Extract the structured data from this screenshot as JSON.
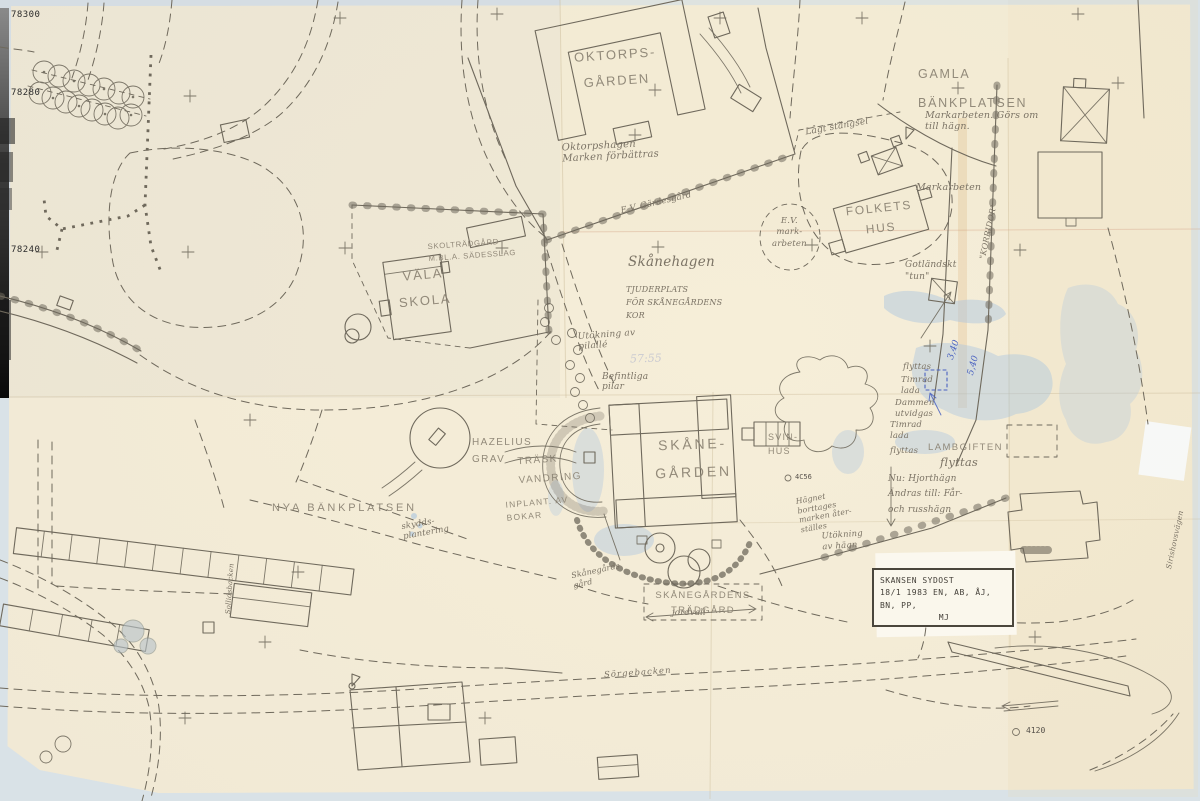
{
  "grid_labels": {
    "top": "78300",
    "middle": "78280",
    "bottom": "78240"
  },
  "survey_points": {
    "pt_4120": "4120",
    "pt_4c56": "4C56",
    "parcel": "57:55"
  },
  "measurements_blue": {
    "a": "3,40",
    "b": "5,40"
  },
  "stamp": {
    "line1": "SKANSEN SYDOST",
    "line2": "18/1 1983 EN, AB, ÅJ, BN, PP,",
    "line3": "MJ"
  },
  "labels": {
    "oktorpsgarden": "OKTORPS-\nGÅRDEN",
    "oktorpshagen": "Oktorpshagen\nMarken förbättras",
    "gamla_bankplatsen": "GAMLA\nBÄNKPLATSEN",
    "gamla_note": "Markarbeten. Görs om\ntill hägn.",
    "lagt_stangsel": "Lågt stängsel",
    "markarbeten": "Markarbeten",
    "ev_markarbeten": "E.V.\nmark-\narbeten",
    "ev_gardesgard": "E.V. Gärdesgård",
    "folkets_hus": "FOLKETS\nHUS",
    "korridor": "\"KORRIDOR\"",
    "gotlandskt_tun": "Gotländskt\n\"tun\"",
    "skanehagen": "Skånehagen",
    "tjuderplats": "TJUDERPLATS\nFÖR SKÅNEGÅRDENS\nKOR",
    "vala_skola": "VÄLA\nSKOLA",
    "skoltradgard": "SKOLTRÄDGÅRD\nM.BL.A. SÄDESSLAG",
    "utokning_pilalle": "Utökning av\npilallé",
    "befintliga_pilar": "Befintliga\npilar",
    "skanegarden": "SKÅNE-\nGÅRDEN",
    "svinhus": "SVIN-\nHUS",
    "hazelius_grav": "HAZELIUS\nGRAV",
    "traskvandring": "TRÄSK-\nVANDRING",
    "inplant_bokar": "INPLANT. AV\nBOKAR",
    "nya_bankplatsen": "NYA BÄNKPLATSEN",
    "skyddsplantering": "skydds-\nplantering",
    "flyttas_a": "flyttas",
    "timrad_lada_a": "Timrad\nlada",
    "dammen_utvidgas": "Dammen\nutvidgas",
    "timrad_lada_b": "Timrad\nlada",
    "flyttas_b": "flyttas",
    "lambgiften": "LAMBGIFTEN",
    "lambgiften_note": "flyttas",
    "hjorthagn_note": "Nu: Hjorthägn\nÄndras till: Får-\noch russhägn",
    "hagnet_note": "Hägnet\nborttages\nmarken åter-\nställes",
    "utokning_hagn": "Utökning\nav hägn",
    "skanegardens_tradgard": "SKÅNEGÅRDENS\nTRÄDGÅRD",
    "jordvall": "jordvall",
    "skanegards_gard": "Skånegårds\ngård",
    "sorgebacken": "Sörgebacken",
    "sirishovsvagen": "Sirishovsvägen",
    "sollidsbacken": "Sollidsbacken"
  }
}
